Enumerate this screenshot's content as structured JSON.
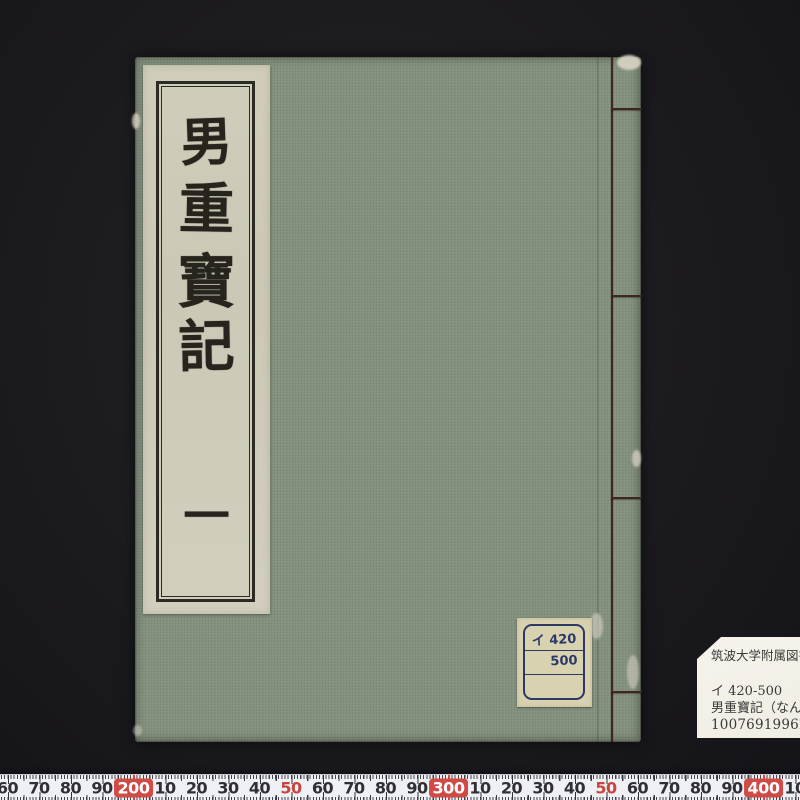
{
  "photo": {
    "subject": "traditional-japanese-stab-bound-book-on-black-background",
    "background_color": "#1b1a1e"
  },
  "book": {
    "cover_color": "#85927f",
    "title_label": {
      "chars": [
        "男",
        "重",
        "寶",
        "記"
      ],
      "volume": "一",
      "full_title": "男重寶記 一"
    },
    "call_number_label": {
      "rows": [
        "イ 420",
        "500",
        ""
      ]
    },
    "binding": {
      "thread_color": "#42261e",
      "style": "four-hole-stab-binding"
    }
  },
  "library_card": {
    "institution": "筑波大学附属図書館",
    "call_number": "イ 420-500",
    "title": "男重寶記（なんちょうほうき）",
    "barcode_number": "10076919962"
  },
  "ruler": {
    "unit": "mm",
    "red_color": "#d04b45",
    "labels": [
      {
        "text": "60",
        "x": 7.5,
        "style": "normal"
      },
      {
        "text": "70",
        "x": 39,
        "style": "normal"
      },
      {
        "text": "80",
        "x": 70.5,
        "style": "normal"
      },
      {
        "text": "90",
        "x": 102,
        "style": "normal"
      },
      {
        "text": "200",
        "x": 133.5,
        "style": "hundred"
      },
      {
        "text": "10",
        "x": 165,
        "style": "normal"
      },
      {
        "text": "20",
        "x": 196.5,
        "style": "normal"
      },
      {
        "text": "30",
        "x": 228,
        "style": "normal"
      },
      {
        "text": "40",
        "x": 259.5,
        "style": "normal"
      },
      {
        "text": "50",
        "x": 291,
        "style": "red"
      },
      {
        "text": "60",
        "x": 322.5,
        "style": "normal"
      },
      {
        "text": "70",
        "x": 354,
        "style": "normal"
      },
      {
        "text": "80",
        "x": 385.5,
        "style": "normal"
      },
      {
        "text": "90",
        "x": 417,
        "style": "normal"
      },
      {
        "text": "300",
        "x": 448.5,
        "style": "hundred"
      },
      {
        "text": "10",
        "x": 480,
        "style": "normal"
      },
      {
        "text": "20",
        "x": 511.5,
        "style": "normal"
      },
      {
        "text": "30",
        "x": 543,
        "style": "normal"
      },
      {
        "text": "40",
        "x": 574.5,
        "style": "normal"
      },
      {
        "text": "50",
        "x": 606,
        "style": "red"
      },
      {
        "text": "60",
        "x": 637.5,
        "style": "normal"
      },
      {
        "text": "70",
        "x": 669,
        "style": "normal"
      },
      {
        "text": "80",
        "x": 700.5,
        "style": "normal"
      },
      {
        "text": "90",
        "x": 732,
        "style": "normal"
      },
      {
        "text": "400",
        "x": 763.5,
        "style": "hundred"
      },
      {
        "text": "10",
        "x": 795,
        "style": "normal"
      }
    ]
  }
}
